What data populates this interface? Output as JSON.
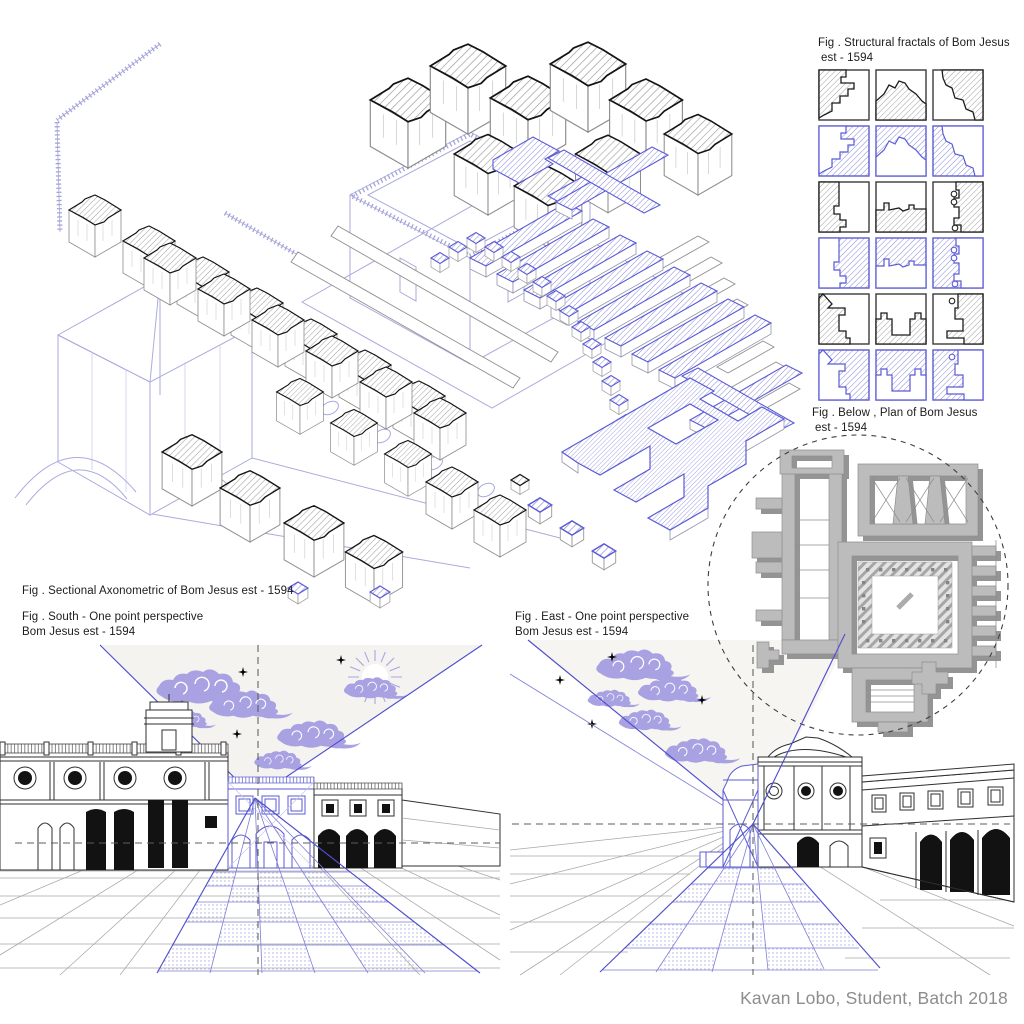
{
  "page": {
    "credit": "Kavan Lobo, Student, Batch 2018",
    "background": "#ffffff"
  },
  "palette": {
    "ink": "#2f2f2f",
    "blue_accent": "#5b5bd6",
    "wireframe_lavender": "#abaade",
    "cloud_lavender": "#a9a2e2",
    "plan_gray": "#bcbcbc",
    "plan_shadow_gray": "#949494",
    "sky_tint": "#f4f3f0",
    "credit_gray": "#8d8d8d"
  },
  "figures": {
    "axonometric": {
      "caption": "Fig . Sectional Axonometric of Bom Jesus est - 1594"
    },
    "fractals": {
      "caption_line1": "Fig . Structural fractals of Bom Jesus",
      "caption_line2": "est - 1594",
      "grid_rows": 6,
      "grid_cols": 3,
      "row_styles": [
        "black-hatch",
        "blue-inverse",
        "black-hatch",
        "blue-inverse",
        "black-hatch",
        "blue-inverse"
      ]
    },
    "plan": {
      "caption_line1": "Fig . Below , Plan of Bom Jesus",
      "caption_line2": "est - 1594"
    },
    "perspective_south": {
      "caption_line1": "Fig . South - One point perspective",
      "caption_line2": "Bom Jesus est - 1594"
    },
    "perspective_east": {
      "caption_line1": "Fig . East - One point perspective",
      "caption_line2": "Bom Jesus est - 1594"
    }
  }
}
